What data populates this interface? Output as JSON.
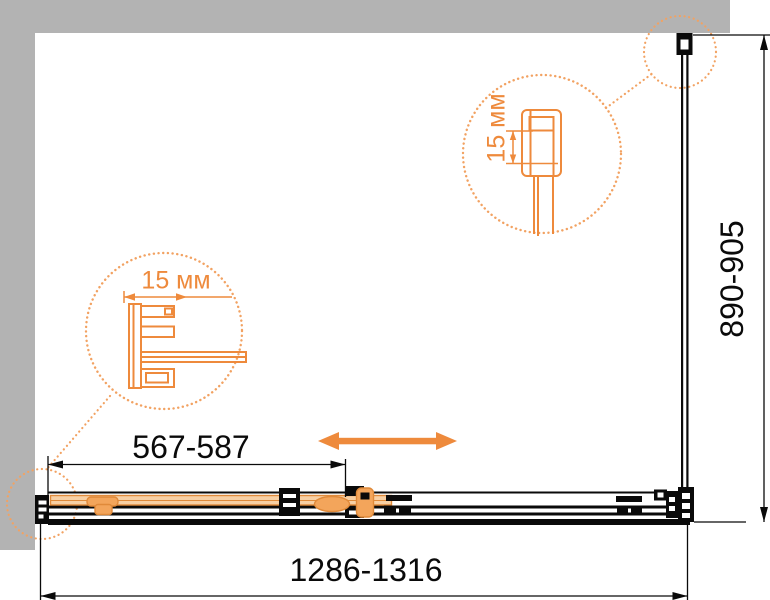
{
  "drawing": {
    "type": "shower-enclosure-plan-view",
    "dimensions": {
      "total_width": "1286-1316",
      "door_panel_width": "567-587",
      "side_panel_depth": "890-905",
      "top_wall_profile_adjustment": "15 мм",
      "left_wall_profile_adjustment": "15 мм"
    },
    "icons": {
      "slide_direction_arrow": "double-headed-horizontal-arrow"
    }
  },
  "colors": {
    "wall": "#b3b3b3",
    "line": "#0a0a0a",
    "accent": "#ee8a3c",
    "accent-dot": "#f2a262",
    "glass": "#f8d0a4",
    "glass-edge": "#e08a3a",
    "roller": "#f3a55b",
    "background": "#ffffff"
  }
}
